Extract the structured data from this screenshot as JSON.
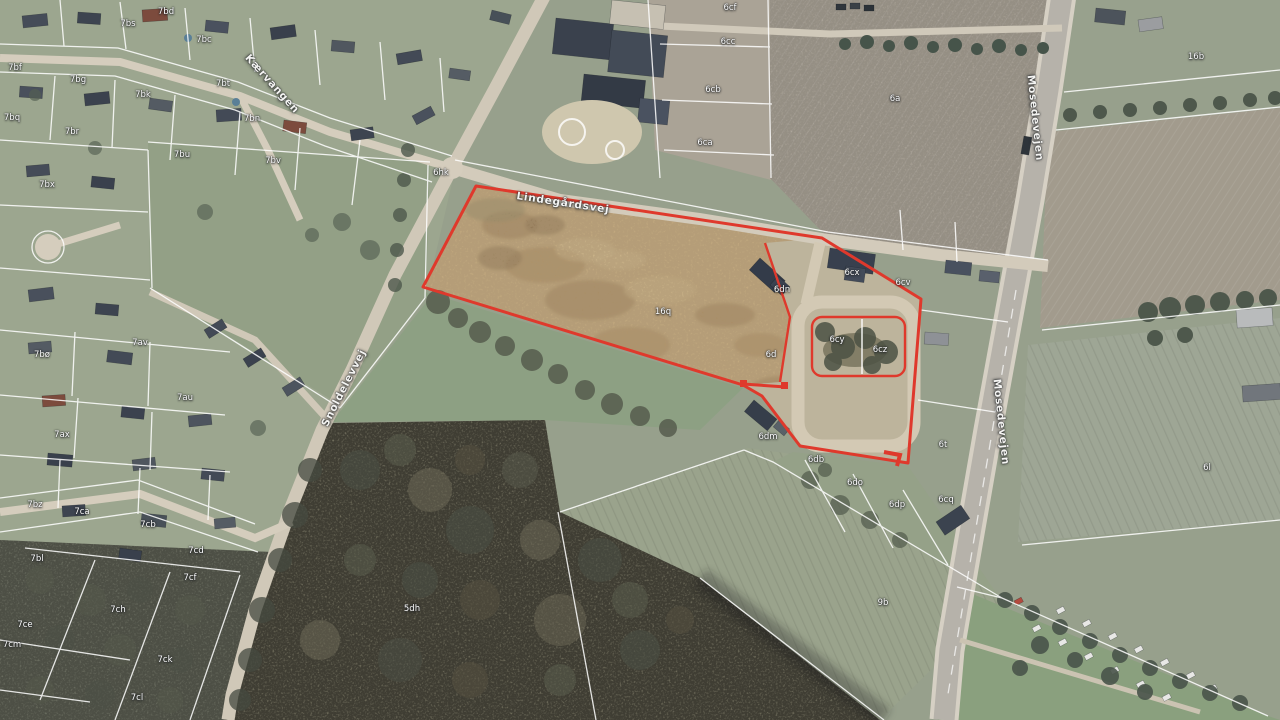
{
  "map": {
    "highlight": {
      "outline_color": "#df392c",
      "selected_parcel": "16q"
    },
    "cadastral_line_color": "#ffffff",
    "road_labels": [
      {
        "text": "Lindegårdsvej",
        "x": 563,
        "y": 203,
        "rot": 8.5
      },
      {
        "text": "Snoldelevvej",
        "x": 344,
        "y": 388,
        "rot": -63
      },
      {
        "text": "Kærvangen",
        "x": 272,
        "y": 84,
        "rot": 48
      },
      {
        "text": "Mosedevejen",
        "x": 1035,
        "y": 118,
        "rot": 84
      },
      {
        "text": "Mosedevejen",
        "x": 1001,
        "y": 422,
        "rot": 84
      }
    ],
    "parcel_labels": [
      {
        "text": "7bd",
        "x": 166,
        "y": 12
      },
      {
        "text": "7bs",
        "x": 128,
        "y": 24
      },
      {
        "text": "7bc",
        "x": 204,
        "y": 40
      },
      {
        "text": "7bf",
        "x": 15,
        "y": 68
      },
      {
        "text": "7bg",
        "x": 78,
        "y": 80
      },
      {
        "text": "7bt",
        "x": 223,
        "y": 84
      },
      {
        "text": "7bk",
        "x": 143,
        "y": 95
      },
      {
        "text": "7bq",
        "x": 12,
        "y": 118
      },
      {
        "text": "7br",
        "x": 72,
        "y": 132
      },
      {
        "text": "7bn",
        "x": 252,
        "y": 119
      },
      {
        "text": "7bu",
        "x": 182,
        "y": 155
      },
      {
        "text": "7bv",
        "x": 273,
        "y": 161
      },
      {
        "text": "7bx",
        "x": 47,
        "y": 185
      },
      {
        "text": "7bø",
        "x": 42,
        "y": 355
      },
      {
        "text": "7av",
        "x": 140,
        "y": 343
      },
      {
        "text": "7au",
        "x": 185,
        "y": 398
      },
      {
        "text": "7ax",
        "x": 62,
        "y": 435
      },
      {
        "text": "7bz",
        "x": 35,
        "y": 505
      },
      {
        "text": "7ca",
        "x": 82,
        "y": 512
      },
      {
        "text": "7cb",
        "x": 148,
        "y": 525
      },
      {
        "text": "7cd",
        "x": 196,
        "y": 551
      },
      {
        "text": "7bl",
        "x": 37,
        "y": 559
      },
      {
        "text": "7cf",
        "x": 190,
        "y": 578
      },
      {
        "text": "7ch",
        "x": 118,
        "y": 610
      },
      {
        "text": "7ce",
        "x": 25,
        "y": 625
      },
      {
        "text": "7cm",
        "x": 12,
        "y": 645
      },
      {
        "text": "7ck",
        "x": 165,
        "y": 660
      },
      {
        "text": "7cl",
        "x": 137,
        "y": 698
      },
      {
        "text": "6hk",
        "x": 441,
        "y": 173
      },
      {
        "text": "6cf",
        "x": 730,
        "y": 8
      },
      {
        "text": "6cc",
        "x": 728,
        "y": 42
      },
      {
        "text": "6cb",
        "x": 713,
        "y": 90
      },
      {
        "text": "6ca",
        "x": 705,
        "y": 143
      },
      {
        "text": "6a",
        "x": 895,
        "y": 99
      },
      {
        "text": "16b",
        "x": 1196,
        "y": 57
      },
      {
        "text": "16q",
        "x": 663,
        "y": 312
      },
      {
        "text": "6dn",
        "x": 782,
        "y": 290
      },
      {
        "text": "6cx",
        "x": 852,
        "y": 273
      },
      {
        "text": "6cv",
        "x": 903,
        "y": 283
      },
      {
        "text": "6d",
        "x": 771,
        "y": 355
      },
      {
        "text": "6cy",
        "x": 837,
        "y": 340
      },
      {
        "text": "6cz",
        "x": 880,
        "y": 350
      },
      {
        "text": "6dm",
        "x": 768,
        "y": 437
      },
      {
        "text": "6db",
        "x": 816,
        "y": 460
      },
      {
        "text": "6do",
        "x": 855,
        "y": 483
      },
      {
        "text": "6dp",
        "x": 897,
        "y": 505
      },
      {
        "text": "6t",
        "x": 943,
        "y": 445
      },
      {
        "text": "6cq",
        "x": 946,
        "y": 500
      },
      {
        "text": "6l",
        "x": 1207,
        "y": 468
      },
      {
        "text": "5dh",
        "x": 412,
        "y": 609
      },
      {
        "text": "9b",
        "x": 883,
        "y": 603
      }
    ]
  }
}
